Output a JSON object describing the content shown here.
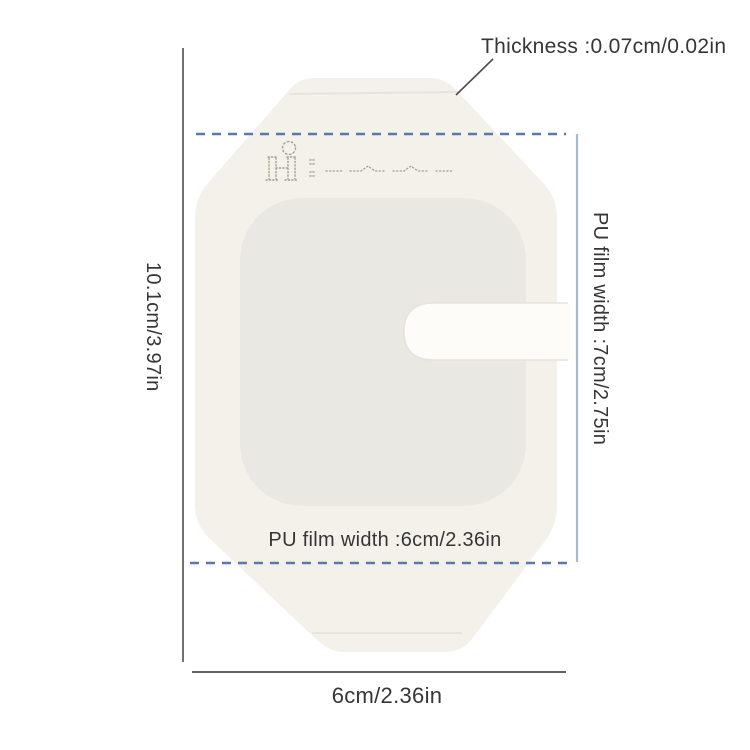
{
  "colors": {
    "bg": "#ffffff",
    "film": "#f3f1ea",
    "pad": "#eae8e2",
    "slot": "#fdfcf9",
    "slot-edge": "#e6e3db",
    "fold": "#e7e4db",
    "print": "#a99f8f",
    "dash-blue": "#5a78ad",
    "measure-blue": "#a6bacf",
    "measure-dark": "#4d4d4d",
    "text": "#363636"
  },
  "labels": {
    "thickness": "Thickness :0.07cm/0.02in",
    "overall_height": "10.1cm/3.97in",
    "pu_film_width_right": "PU film width :7cm/2.75in",
    "pu_film_width_bottom": "PU film width :6cm/2.36in",
    "overall_width": "6cm/2.36in"
  },
  "icons": {
    "brand_print": "dotted-brand-print-icon"
  }
}
